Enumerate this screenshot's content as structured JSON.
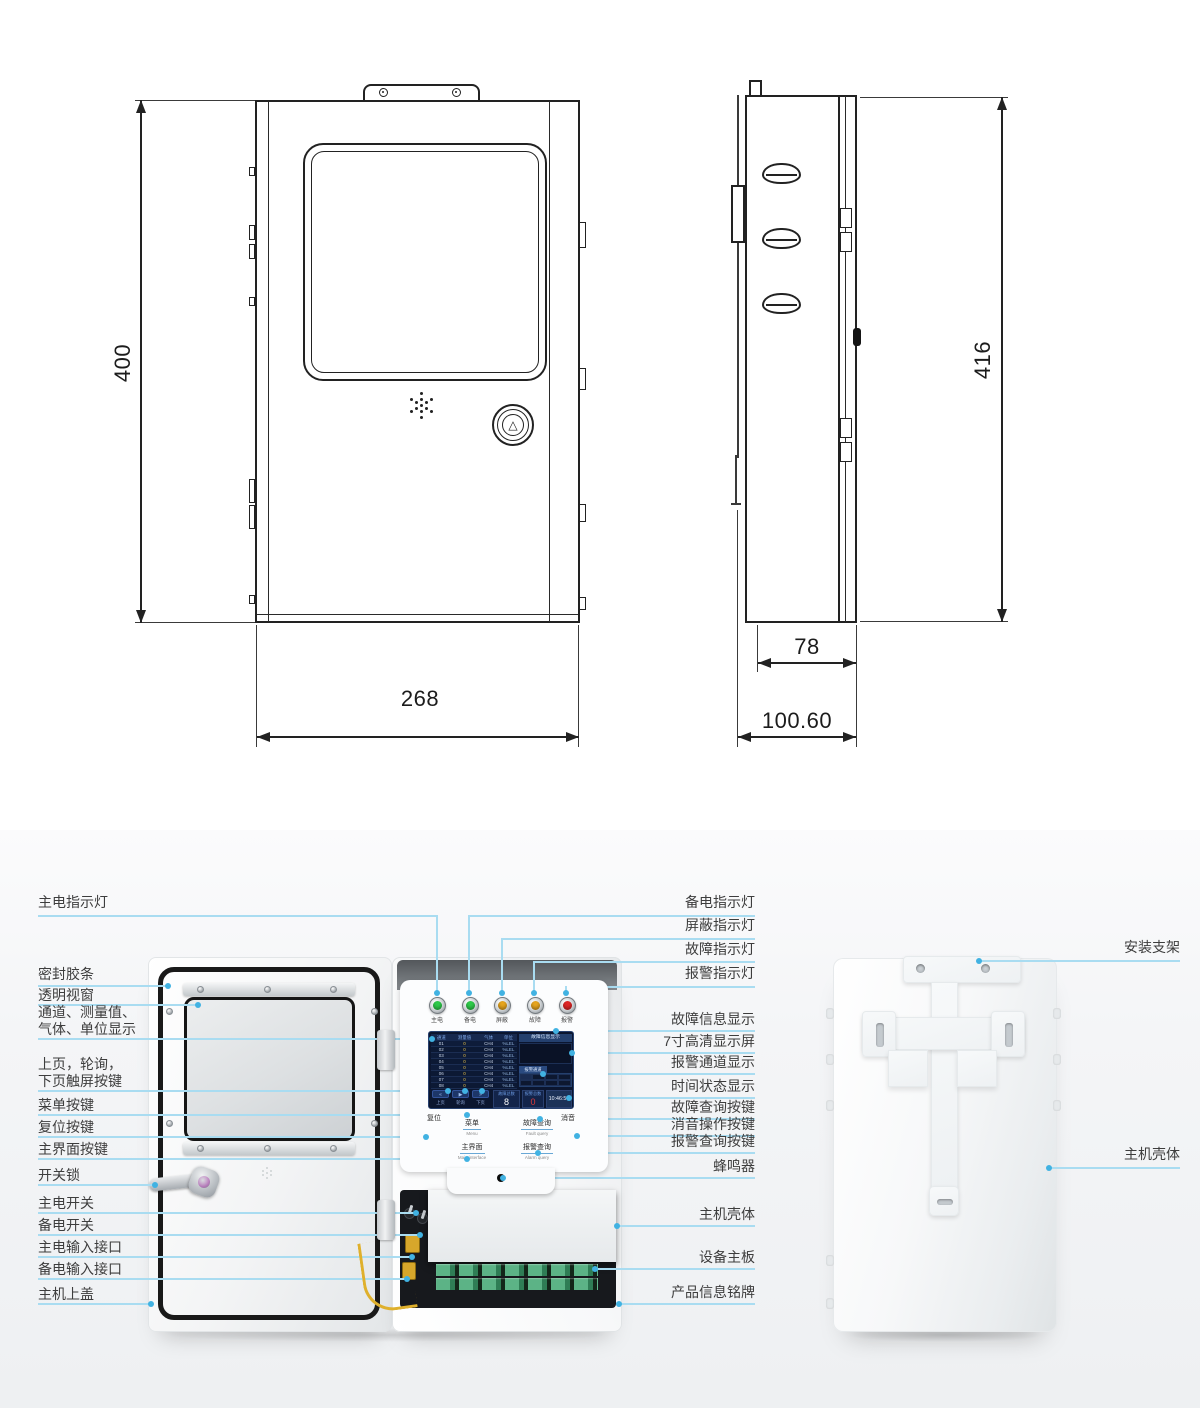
{
  "dimensions": {
    "front_height": "400",
    "front_width": "268",
    "side_height": "416",
    "side_depth": "78",
    "side_total_depth": "100.60"
  },
  "callouts": {
    "left": [
      "主电指示灯",
      "密封胶条",
      "透明视窗",
      [
        "通道、测量值、",
        "气体、单位显示"
      ],
      [
        "上页，轮询，",
        "下页触屏按键"
      ],
      "菜单按键",
      "复位按键",
      "主界面按键",
      "开关锁",
      "主电开关",
      "备电开关",
      "主电输入接口",
      "备电输入接口",
      "主机上盖"
    ],
    "right": [
      "备电指示灯",
      "屏蔽指示灯",
      "故障指示灯",
      "报警指示灯",
      "故障信息显示",
      "7寸高清显示屏",
      "报警通道显示",
      "时间状态显示",
      "故障查询按键",
      "消音操作按键",
      "报警查询按键",
      "蜂鸣器",
      "主机壳体",
      "设备主板",
      "产品信息铭牌"
    ],
    "far_right": [
      "安装支架",
      "主机壳体"
    ]
  },
  "panel": {
    "indicators": [
      {
        "label": "主电",
        "color": "#2ecc4a"
      },
      {
        "label": "备电",
        "color": "#2ecc4a"
      },
      {
        "label": "屏蔽",
        "color": "#e8a61e"
      },
      {
        "label": "故障",
        "color": "#e8a61e"
      },
      {
        "label": "报警",
        "color": "#e02626"
      }
    ],
    "screen": {
      "table_headers": [
        "通道",
        "测量值",
        "气体",
        "单位"
      ],
      "rows": [
        [
          "01",
          "0",
          "CH4",
          "%LEL"
        ],
        [
          "02",
          "0",
          "CH4",
          "%LEL"
        ],
        [
          "03",
          "0",
          "CH4",
          "%LEL"
        ],
        [
          "04",
          "0",
          "CH4",
          "%LEL"
        ],
        [
          "05",
          "0",
          "CH4",
          "%LEL"
        ],
        [
          "06",
          "0",
          "CH4",
          "%LEL"
        ],
        [
          "07",
          "0",
          "CH4",
          "%LEL"
        ],
        [
          "08",
          "0",
          "CH4",
          "%LEL"
        ]
      ],
      "info_title": "故障信息显示",
      "alarm_tab": "报警通道",
      "touch_buttons": [
        {
          "icon": "«",
          "label": "上页"
        },
        {
          "icon": "▶",
          "label": "轮询"
        },
        {
          "icon": "»",
          "label": "下页"
        }
      ],
      "fault_total_label": "故障总数",
      "fault_total": "8",
      "alarm_total_label": "报警总数",
      "alarm_total": "0",
      "time": "10:46:55"
    },
    "buttons": {
      "reset": "复位",
      "menu": "菜单",
      "menu_en": "Menu",
      "main": "主界面",
      "main_en": "Main interface",
      "fault_query": "故障查询",
      "fault_query_en": "Fault query",
      "alarm_query": "报警查询",
      "alarm_query_en": "Alarm query",
      "mute": "消音"
    },
    "front_button_icon": "△"
  },
  "colors": {
    "leader_line": "#a9dcf1",
    "leader_dot": "#41b2e2",
    "drawing_line": "#222222"
  }
}
